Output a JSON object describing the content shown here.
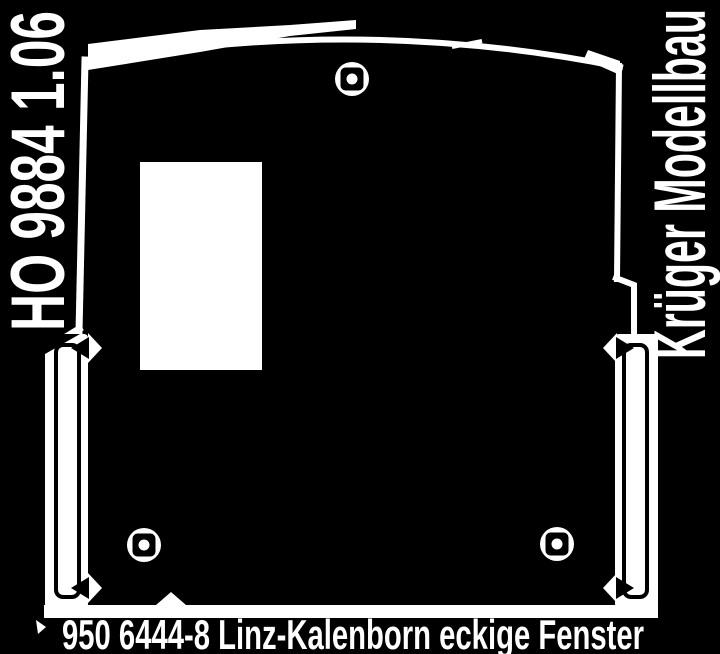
{
  "scan": {
    "background_color": "#000000",
    "line_color": "#ffffff",
    "labels": {
      "left_vertical": "HO 9884 1.06",
      "right_vertical": "Krüger Modellbau",
      "bottom": "950 6444-8 Linz-Kalenborn eckige Fenster"
    },
    "icons": {
      "screw_hole_marker": "circle-with-center-dot",
      "fold_tab": "elongated-tab-with-chevron-notches"
    }
  }
}
